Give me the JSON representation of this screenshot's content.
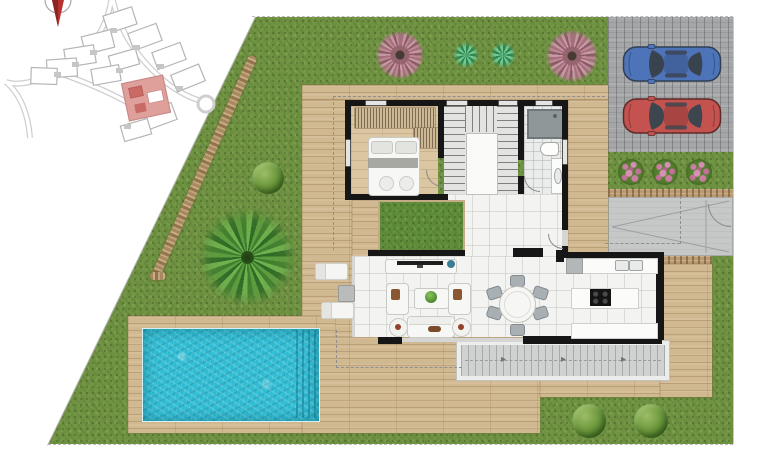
{
  "document": {
    "type": "villa floor plan with landscaped plot (top view render)"
  },
  "colors": {
    "lawn_green": "#6f9242",
    "courtyard_green": "#5f8c3a",
    "deck_wood": "#d0b890",
    "bedroom_wood": "#dbc6a2",
    "parking_gray": "#a4a6a7",
    "path_gray": "#c6c8c7",
    "stone_brown": "#b99a72",
    "tile_white": "#f3f3f1",
    "wall_black": "#161616",
    "pool_water": "#2fbcd2",
    "car_blue": "#4d74b8",
    "car_red": "#c4524e",
    "site_highlight": "#dfa09c",
    "compass_red": "#b5322e"
  },
  "site_key_plan": {
    "highlighted_unit": true,
    "compass": "north-arrow",
    "street_layout": "curved residential streets with cul-de-sac"
  },
  "plot": {
    "boundary": "dashed property lines, diagonal left edge",
    "lawn": true,
    "stone_path": true,
    "plants": [
      "pink-flowering-tree",
      "agave",
      "agave",
      "pink-flowering-tree",
      "round-bush",
      "palm-tree",
      "round-bush",
      "round-bush",
      "flower-bush",
      "flower-bush",
      "flower-bush"
    ],
    "pool": {
      "shape": "rectangular",
      "steps": "right end",
      "surround": "wood deck"
    },
    "parking": {
      "surface": "gray decking",
      "cars": [
        {
          "color_name": "blue",
          "hex": "#4d74b8"
        },
        {
          "color_name": "red",
          "hex": "#c4524e"
        }
      ],
      "flower_bed": "three pink flower bushes"
    },
    "entrance_path": {
      "surface": "concrete",
      "gate": true
    },
    "terrace": {
      "sun_loungers": 2,
      "side_table": 1,
      "exterior_stairs": "wide steps along south side"
    }
  },
  "house": {
    "rooms": [
      {
        "name": "bedroom",
        "floor": "wood",
        "furniture": [
          "double-bed",
          "built-in-wardrobe"
        ]
      },
      {
        "name": "staircase",
        "type": "u-shaped around void"
      },
      {
        "name": "bathroom",
        "fixtures": [
          "shower",
          "toilet",
          "washbasin"
        ]
      },
      {
        "name": "hallway",
        "floor": "tile"
      },
      {
        "name": "inner-courtyard",
        "floor": "grass"
      },
      {
        "name": "living-room",
        "furniture": [
          "tv-sideboard",
          "armchair",
          "armchair",
          "coffee-table-with-plant",
          "sofa",
          "side-table",
          "side-table"
        ]
      },
      {
        "name": "dining-area",
        "furniture": [
          "round-table",
          "six-chairs"
        ]
      },
      {
        "name": "kitchen",
        "furniture": [
          "counter-with-double-sink",
          "island-with-hob",
          "lower-counter"
        ]
      }
    ],
    "glazing": "sliding glass walls to west and south terraces"
  }
}
